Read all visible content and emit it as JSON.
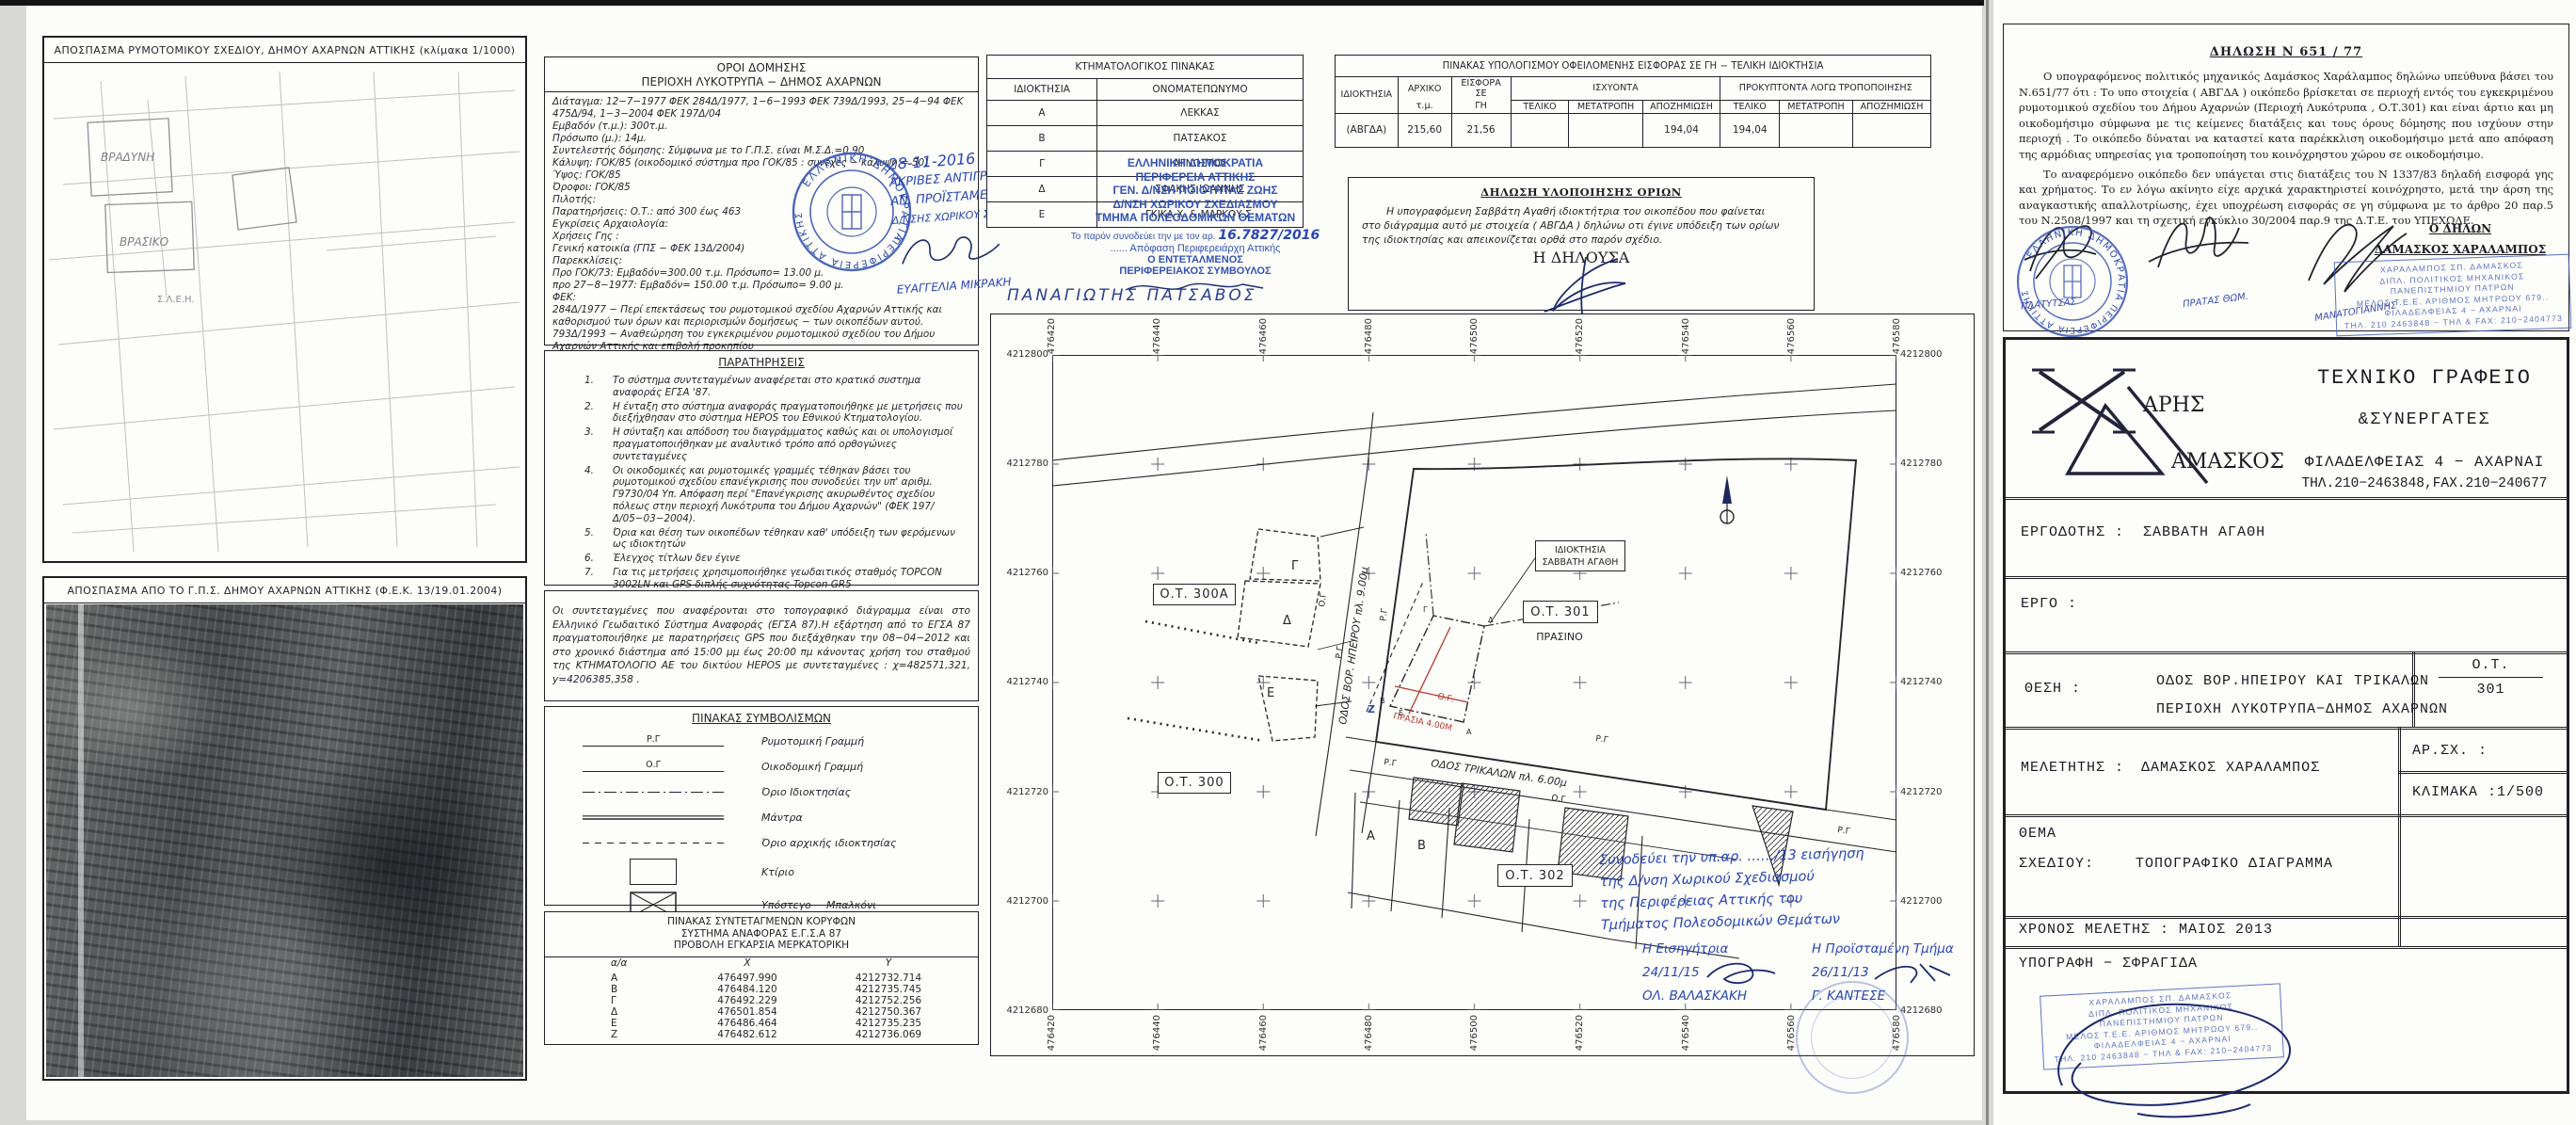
{
  "maps": {
    "map1_title": "ΑΠΟΣΠΑΣΜΑ ΡΥΜΟΤΟΜΙΚΟΥ ΣΧΕΔΙΟΥ,  ΔΗΜΟΥ ΑΧΑΡΝΩΝ ΑΤΤΙΚΗΣ  (κλίμακα 1/1000)",
    "map2_title": "ΑΠΟΣΠΑΣΜΑ ΑΠΟ ΤΟ Γ.Π.Σ. ΔΗΜΟΥ ΑΧΑΡΝΩΝ ΑΤΤΙΚΗΣ (Φ.Ε.Κ. 13/19.01.2004)",
    "map1_label_a": "ΒΡΑΔΥΝΗ",
    "map1_label_b": "ΒΡΑΣΙΚΟ",
    "map1_label_c": "Σ.Λ.Ε.Η."
  },
  "oroi": {
    "title": "ΟΡΟΙ ΔΟΜΗΣΗΣ",
    "subtitle": "ΠΕΡΙΟΧΗ ΛΥΚΟΤΡΥΠΑ − ΔΗΜΟΣ ΑΧΑΡΝΩΝ",
    "lines": [
      "Διάταγμα: 12−7−1977 ΦΕΚ 284Δ/1977, 1−6−1993 ΦΕΚ 739Δ/1993, 25−4−94 ΦΕΚ 475Δ/94, 1−3−2004 ΦΕΚ 197Δ/04",
      "Εμβαδόν (τ.μ.):  300τ.μ.",
      "Πρόσωπο (μ.):  14μ.",
      "Συντελεστής δόμησης:  Σύμφωνα με το Γ.Π.Σ. είναι Μ.Σ.Δ.=0.90",
      "Κάλυψη: ΓΟΚ/85 (οικοδομικό σύστημα προ ΓΟΚ/85 : συνεχές − κάλυψη = 50)",
      "Ύψος: ΓΟΚ/85",
      "Όροφοι: ΓΟΚ/85",
      "Πιλοτής:",
      "Παρατηρήσεις: Ο.Τ.: από 300 έως 463",
      "Εγκρίσεις Αρχαιολογία:",
      "Χρήσεις Γης :",
      "Γενική κατοικία (ΓΠΣ − ΦΕΚ 13Δ/2004)",
      "Παρεκκλίσεις:",
      "Προ ΓΟΚ/73: Εμβαδόν=300.00 τ.μ. Πρόσωπο= 13.00 μ.",
      "προ 27−8−1977: Εμβαδόν= 150.00 τ.μ. Πρόσωπο= 9.00 μ.",
      "ΦΕΚ:",
      "284Δ/1977 − Περί επεκτάσεως του ρυμοτομικού σχεδίου Αχαρνών Αττικής και καθορισμού των όρων και περιορισμών δομήσεως − των οικοπέδων αυτού.",
      "793Δ/1993 − Αναθεώρηση του εγκεκριμένου ρυμοτομικού σχεδίου του Δήμου Αχαρνών Αττικής και επιβολή προκηπίου",
      "475Δ/94 Αναθεώρηση σχεδίου",
      "197Δ/04 Επανέγκριση σχεδίου"
    ]
  },
  "copy_note": {
    "date": "28-11-2016",
    "l1": "ΑΚΡΙΒΕΣ ΑΝΤΙΓΡΑΦΟ",
    "l2": "ΑΝ. ΠΡΟΪΣΤΑΜΕΝΗ",
    "l3": "Δ/ΝΣΗΣ ΧΩΡΙΚΟΥ ΣΧΕΔΙΑΣΜΟΥ",
    "name": "ΕΥΑΓΓΕΛΙΑ ΜΙΚΡΑΚΗ"
  },
  "round_stamp": {
    "l1": "ΕΛΛΗΝΙΚΗ ΔΗΜΟΚΡΑΤΙΑ",
    "l2": "ΠΕΡΙΦΕΡΕΙΑ ΑΤΤΙΚΗΣ"
  },
  "paratiriseis": {
    "title": "ΠΑΡΑΤΗΡΗΣΕΙΣ",
    "items": [
      {
        "n": "1.",
        "t": "Το σύστημα συντεταγμένων αναφέρεται στο κρατικό συστημα αναφοράς ΕΓΣΑ '87."
      },
      {
        "n": "2.",
        "t": "Η ένταξη στο σύστημα αναφοράς πραγματοποιήθηκε με μετρήσεις που διεξήχθησαν στο σύστημα HEPOS του Εθνικού Κτηματολογίου."
      },
      {
        "n": "3.",
        "t": "Η σύνταξη και απόδοση του διαγράμματος καθώς και οι υπολογισμοί πραγματοποιήθηκαν με αναλυτικό τρόπο από ορθογώνιες συντεταγμένες"
      },
      {
        "n": "4.",
        "t": "Οι οικοδομικές και ρυμοτομικές γραμμές τέθηκαν βάσει του ρυμοτομικού σχεδίου επανέγκρισης που συνοδεύει την υπ' αριθμ. Γ9730/04 Υπ. Απόφαση περί \"Επανέγκρισης ακυρωθέντος σχεδίου πόλεως στην περιοχή Λυκότρυπα του Δήμου Αχαρνών\" (ΦΕΚ 197/Δ/05−03−2004)."
      },
      {
        "n": "5.",
        "t": "Όρια και θέση των οικοπέδων τέθηκαν καθ' υπόδειξη των φερόμενων ως ιδιοκτητών"
      },
      {
        "n": "6.",
        "t": "Έλεγχος τίτλων δεν έγινε"
      },
      {
        "n": "7.",
        "t": "Για τις μετρήσεις χρησιμοποιήθηκε γεωδαιτικός σταθμός TOPCON 3002LN και GPS διπλής συχνότητας Topcon GR5"
      }
    ]
  },
  "gps_note": "Οι συντεταγμένες που αναφέρονται στο τοπογραφικό διάγραμμα είναι στο Ελληνικό Γεωδαιτικό Σύστημα Αναφοράς (ΕΓΣΑ 87).Η εξάρτηση από το ΕΓΣΑ 87 πραγματοποιήθηκε με παρατηρήσεις GPS που διεξάχθηκαν την 08−04−2012 και στο χρονικό διάστημα από 15:00 μμ έως 20:00 πμ κάνοντας χρήση του σταθμού της ΚΤΗΜΑΤΟΛΟΓΙΟ ΑΕ  του δικτύου HEPOS  με συντεταγμένες :  χ=482571,321,   y=4206385,358 .",
  "legend": {
    "title": "ΠΙΝΑΚΑΣ ΣΥΜΒΟΛΙΣΜΩΝ",
    "rg": "Ρ.Γ",
    "og": "Ο.Γ",
    "rows": [
      "Ρυμοτομική Γραμμή",
      "Οικοδομική Γραμμή",
      "Όριο Ιδιοκτησίας",
      "Μάντρα",
      "Όριο αρχικής ιδιοκτησίας",
      "Κτίριο",
      "Υπόστεγο − Μπαλκόνι"
    ]
  },
  "coords": {
    "t1": "ΠΙΝΑΚΑΣ ΣΥΝΤΕΤΑΓΜΕΝΩΝ ΚΟΡΥΦΩΝ",
    "t2": "ΣΥΣΤΗΜΑ ΑΝΑΦΟΡΑΣ Ε.Γ.Σ.Α 87",
    "t3": "ΠΡΟΒΟΛΗ ΕΓΚΑΡΣΙΑ ΜΕΡΚΑΤΟΡΙΚΗ",
    "h": {
      "a": "α/α",
      "x": "X",
      "y": "Y"
    },
    "rows": [
      {
        "a": "Α",
        "x": "476497.990",
        "y": "4212732.714"
      },
      {
        "a": "Β",
        "x": "476484.120",
        "y": "4212735.745"
      },
      {
        "a": "Γ",
        "x": "476492.229",
        "y": "4212752.256"
      },
      {
        "a": "Δ",
        "x": "476501.854",
        "y": "4212750.367"
      },
      {
        "a": "Ε",
        "x": "476486.464",
        "y": "4212735.235"
      },
      {
        "a": "Ζ",
        "x": "476482.612",
        "y": "4212736.069"
      }
    ]
  },
  "ktima": {
    "title": "ΚΤΗΜΑΤΟΛΟΓΙΚΟΣ ΠΙΝΑΚΑΣ",
    "c1": "ΙΔΙΟΚΤΗΣΙΑ",
    "c2": "ΟΝΟΜΑΤΕΠΩΝΥΜΟ",
    "rows": [
      {
        "k": "Α",
        "v": "ΛΕΚΚΑΣ"
      },
      {
        "k": "Β",
        "v": "ΠΑΤΣΑΚΟΣ"
      },
      {
        "k": "Γ",
        "v": "ΑΓΝΩΣΤΟΣ"
      },
      {
        "k": "Δ",
        "v": "ΣΦΑΚΗΣ ΙΩΑΝΝΗΣ"
      },
      {
        "k": "Ε",
        "v": "ΓΚΙΚΑ Χ. & ΜΑΡΚΟΥ Σ."
      }
    ]
  },
  "region_block": {
    "l1": "ΕΛΛΗΝΙΚΗ ΔΗΜΟΚΡΑΤΙΑ",
    "l2": "ΠΕΡΙΦΕΡΕΙΑ ΑΤΤΙΚΗΣ",
    "l3": "ΓΕΝ. Δ/ΝΣΗ ΠΟΙΟΤΗΤΑΣ ΖΩΗΣ",
    "l4": "Δ/ΝΣΗ ΧΩΡΙΚΟΥ ΣΧΕΔΙΑΣΜΟΥ",
    "l5": "ΤΜΗΜΑ ΠΟΛΕΟΔΟΜΙΚΩΝ ΘΕΜΑΤΩΝ",
    "prefix": "Το παρόν συνοδεύει την με τον αρ.",
    "num": "16.7827/2016",
    "l6": "...... Απόφαση Περιφερειάρχη Αττικής",
    "l7": "Ο ΕΝΤΕΤΑΛΜΕΝΟΣ",
    "l8": "ΠΕΡΙΦΕΡΕΙΑΚΟΣ ΣΥΜΒΟΥΛΟΣ",
    "name": "ΠΑΝΑΓΙΩΤΗΣ  ΠΑΤΣΑΒΟΣ"
  },
  "eisfora": {
    "title": "ΠΙΝΑΚΑΣ ΥΠΟΛΟΓΙΣΜΟΥ ΟΦΕΙΛΟΜΕΝΗΣ ΕΙΣΦΟΡΑΣ ΣΕ ΓΗ − ΤΕΛΙΚΗ ΙΔΙΟΚΤΗΣΙΑ",
    "h_idio": "ΙΔΙΟΚΤΗΣΙΑ",
    "h_arxiko": "ΑΡΧΙΚΟ",
    "h_arxiko2": "τ.μ.",
    "h_eisfora": "ΕΙΣΦΟΡΑ ΣΕ",
    "h_eisfora2": "ΓΗ",
    "h_isx": "ΙΣΧΥΟΝΤΑ",
    "h_prok": "ΠΡΟΚΥΠΤΟΝΤΑ ΛΟΓΩ ΤΡΟΠΟΠΟΙΗΣΗΣ",
    "h_teliko": "ΤΕΛΙΚΟ",
    "h_metatropi": "ΜΕΤΑΤΡΟΠΗ",
    "h_apozimiosi": "ΑΠΟΖΗΜΙΩΣΗ",
    "row": {
      "idio": "(ΑΒΓΔΑ)",
      "arxiko": "215,60",
      "eisfora": "21,56",
      "isx_apoz": "194,04",
      "prok_teliko": "194,04"
    }
  },
  "dilosi_orion": {
    "title": "ΔΗΛΩΣΗ ΥΛΟΠΟΙΗΣΗΣ ΟΡΙΩΝ",
    "p1": "Η  υπογραφόμενη  Σαββάτη Αγαθή  ιδιοκτήτρια  του  οικοπέδου που φαίνεται",
    "p2": "στο  διάγραμμα αυτό με  στοιχεία   ( ΑΒΓΔΑ )  δηλώνω οτι  έγινε  υπόδειξη  των  ορίων",
    "p3": "της ιδιοκτησίας και απεικονίζεται ορθά στο παρόν σχέδιο.",
    "signer": "Η ΔΗΛΟΥΣΑ"
  },
  "plot": {
    "x_ticks": [
      "476420",
      "476440",
      "476460",
      "476480",
      "476500",
      "476520",
      "476540",
      "476560",
      "476580"
    ],
    "y_ticks": [
      "4212800",
      "4212780",
      "4212760",
      "4212740",
      "4212720",
      "4212700",
      "4212680"
    ],
    "ot300a": "Ο.Τ. 300Α",
    "ot300": "Ο.Τ. 300",
    "ot301": "Ο.Τ. 301",
    "ot302": "Ο.Τ. 302",
    "prasino": "ΠΡΑΣΙΝΟ",
    "owner1": "ΙΔΙΟΚΤΗΣΙΑ",
    "owner2": "ΣΑΒΒΑΤΗ ΑΓΑΘΗ",
    "street1": "ΟΔΟΣ ΒΟΡ. ΗΠΕΙΡΟΥ πλ. 9.00μ",
    "street2": "ΟΔΟΣ ΤΡΙΚΑΛΩΝ πλ. 6.00μ",
    "rg": "Ρ.Γ",
    "og": "Ο.Γ",
    "og_red": "Ο.Γ.",
    "prasia": "ΠΡΑΣΙΑ 4.00Μ",
    "let_a": "Α",
    "let_b": "Β",
    "let_g": "Γ",
    "let_d": "Δ",
    "let_e": "Ε",
    "let_z": "Ζ",
    "note": {
      "l1": "Συνοδεύει την υπ.αρ. ……/13 εισήγηση",
      "l2": "της Δ/νση Χωρικού Σχεδιασμού",
      "l3": "της Περιφέρειας Αττικής του",
      "l4": "Τμήματος Πολεοδομικών Θεμάτων",
      "role1": "Η Εισηγήτρια",
      "date1": "24/11/15",
      "name1": "ΟΛ. ΒΑΛΑΣΚΑΚΗ",
      "role2": "Η Προϊσταμένη Τμήμα",
      "date2": "26/11/13",
      "name2": "Γ. ΚΑΝΤΕΣΕ"
    }
  },
  "dilosi651": {
    "title": "ΔΗΛΩΣΗ Ν 651 / 77",
    "p1": "Ο υπογραφόμενος πολιτικός μηχανικός Δαμάσκος Χαράλαμπος δηλώνω υπεύθυνα βάσει του Ν.651/77 ότι : Το υπο στοιχεία ( ΑΒΓΔΑ ) οικόπεδο βρίσκεται σε περιοχή  εντός του εγκεκριμένου ρυμοτομικού σχεδίου του Δήμου Αχαρνών (Περιοχή Λυκότρυπα , Ο.Τ.301)  και είναι άρτιο  και μη οικοδομήσιμο σύμφωνα με  τις  κείμενες διατάξεις και τους όρους  δόμησης  που  ισχύουν  στην  περιοχή .  Το οικόπεδο  δύναται  να  καταστεί  κατα παρέκκλιση οικοδομήσιμο μετά απο απόφαση της αρμόδιας υπηρεσίας για τροποποίηση του κοινόχρηστου  χώρου σε οικοδομήσιμο.",
    "p2": "Το αναφερόμενο οικόπεδο δεν  υπάγεται στις διατάξεις του Ν 1337/83   δηλαδή εισφορά γης και χρήματος. Το εν λόγω ακίνητο είχε αρχικά χαρακτηριστεί κοινόχρηστο,  μετά την άρση της αναγκαστικής απαλλοτρίωσης, έχει υποχρέωση εισφοράς σε γη σύμφωνα με το άρθρο 20  παρ.5 του  Ν.2508/1997  και  τη  σχετική  εγκύκλιο 30/2004 παρ.9 της Δ.Τ.Ε. του ΥΠΕΧΩΔΕ.",
    "signer_role": "Ο ΔΗΛΩΝ",
    "signer_name": "ΔΑΜΑΣΚΟΣ ΧΑΡΑΛΑΜΠΟΣ",
    "scribble1": "ΠΛΑΤΥΤΣΑΣ",
    "scribble2": "ΠΡΑΤΑΣ ΘΩΜ.",
    "scribble3": "ΜΑΝΑΤΟΓΙΑΝΝΗΣ"
  },
  "eng_stamp": {
    "l1": "ΧΑΡΑΛΑΜΠΟΣ ΣΠ. ΔΑΜΑΣΚΟΣ",
    "l2": "ΔΙΠΛ. ΠΟΛΙΤΙΚΟΣ ΜΗΧΑΝΙΚΟΣ",
    "l3": "ΠΑΝΕΠΙΣΤΗΜΙΟΥ ΠΑΤΡΩΝ",
    "l4": "ΜΕΛΟΣ Τ.Ε.Ε. ΑΡΙΘΜΟΣ ΜΗΤΡΩΟΥ 679..",
    "l5": "ΦΙΛΑΔΕΛΦΕΙΑΣ 4 − ΑΧΑΡΝΑΙ",
    "l6": "ΤΗΛ. 210 2463848 − ΤΗΛ & FAX: 210−2404773"
  },
  "titleblock": {
    "logo_x_label": "ΑΡΗΣ",
    "logo_d_label": "ΑΜΑΣΚΟΣ",
    "office1": "ΤΕΧΝΙΚΟ  ΓΡΑΦΕΙΟ",
    "office2": "&ΣΥΝΕΡΓΑΤΕΣ",
    "office3": "ΦΙΛΑΔΕΛΦΕΙΑΣ 4 − ΑΧΑΡΝΑΙ",
    "office4": "ΤΗΛ.210−2463848,FAX.210−240677",
    "ergodotis_label": "ΕΡΓΟΔΟΤΗΣ :",
    "ergodotis": "ΣΑΒΒΑΤΗ ΑΓΑΘΗ",
    "ergo_label": "ΕΡΓΟ  :",
    "thesi_label": "ΘΕΣΗ  :",
    "thesi1": "ΟΔΟΣ ΒΟΡ.ΗΠΕΙΡΟΥ ΚΑΙ ΤΡΙΚΑΛΩΝ",
    "thesi2": "ΠΕΡΙΟΧΗ ΛΥΚΟΤΡΥΠΑ−ΔΗΜΟΣ ΑΧΑΡΝΩΝ",
    "ot_label": "Ο.Τ.",
    "ot_value": "301",
    "meletitis_label": "ΜΕΛΕΤΗΤΗΣ :",
    "meletitis": "ΔΑΜΑΣΚΟΣ ΧΑΡΑΛΑΜΠΟΣ",
    "arsx_label": "ΑΡ.ΣΧ. :",
    "klimaka": "ΚΛΙΜΑΚΑ :1/500",
    "thema_label": "ΘΕΜΑ",
    "sxediou_label": "ΣΧΕΔΙΟΥ:",
    "sxedio": "ΤΟΠΟΓΡΑΦΙΚΟ ΔΙΑΓΡΑΜΜΑ",
    "xronos": "ΧΡΟΝΟΣ ΜΕΛΕΤΗΣ : ΜΑΙΟΣ  2013",
    "ypografi": "ΥΠΟΓΡΑΦΗ  −  ΣΦΡΑΓΙΔΑ"
  }
}
